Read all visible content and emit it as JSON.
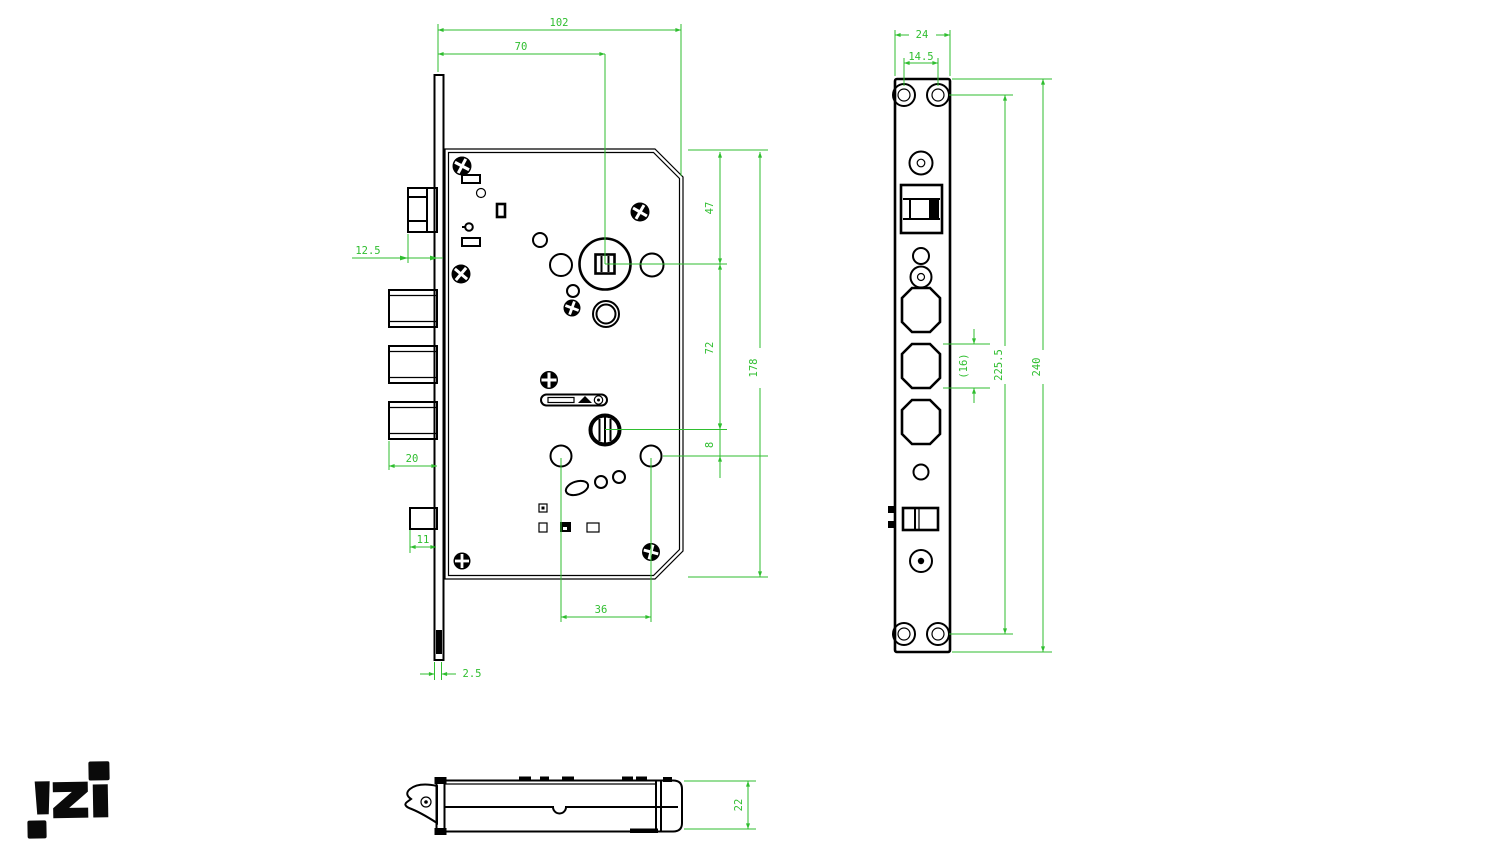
{
  "document": {
    "type": "technical-drawing",
    "subject": "mortise-lock-body"
  },
  "colors": {
    "background": "#ffffff",
    "drawing_lines": "#000000",
    "dimension_lines": "#2fbe2f"
  },
  "dims": {
    "side": {
      "overall_width": "102",
      "backset": "70",
      "latch_offset": "12.5",
      "bolt_throw": "20",
      "aux_bolt": "11",
      "plate_thickness": "2.5",
      "top_to_spindle": "47",
      "spindle_to_cylinder": "72",
      "cylinder_to_handle": "8",
      "case_height": "178",
      "lower_hole_spacing": "36"
    },
    "faceplate": {
      "width": "24",
      "screw_spacing": "14.5",
      "bolt_hole_height": "(16)",
      "screw_span": "225.5",
      "height": "240"
    },
    "bottom": {
      "thickness": "22"
    }
  },
  "logo": {
    "text": "izi"
  }
}
